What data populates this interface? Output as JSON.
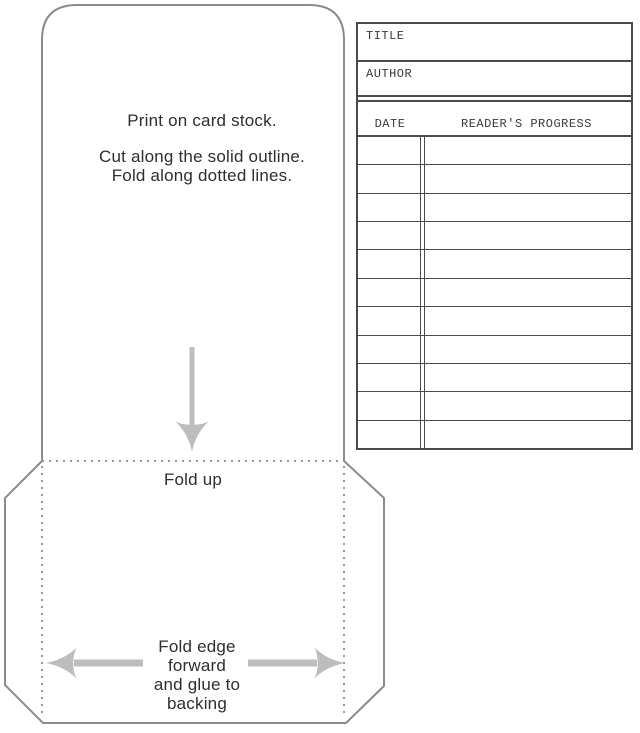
{
  "page_title": "Library card pocket printable template",
  "colors": {
    "outline_gray": "#8b8b8b",
    "dotted_gray": "#979797",
    "arrow_gray": "#bdbdbd",
    "card_line_dark": "#4a4a4a",
    "text_dark": "#2e2e2e",
    "background": "#ffffff"
  },
  "pocket": {
    "instructions_line1": "Print on card stock.",
    "instructions_line2": "Cut along the solid outline.",
    "instructions_line3": "Fold along dotted lines.",
    "fold_up_label": "Fold up"
  },
  "flap": {
    "glue_lines": [
      "Fold edge",
      "forward",
      "and glue to",
      "backing"
    ]
  },
  "card": {
    "title_label": "TITLE",
    "author_label": "AUTHOR",
    "date_label": "DATE",
    "progress_label": "READER'S PROGRESS",
    "ruled_row_count": 11
  },
  "icons": {
    "fold_up_arrow": "down-arrow",
    "glue_left_arrow": "left-arrow",
    "glue_right_arrow": "right-arrow"
  }
}
